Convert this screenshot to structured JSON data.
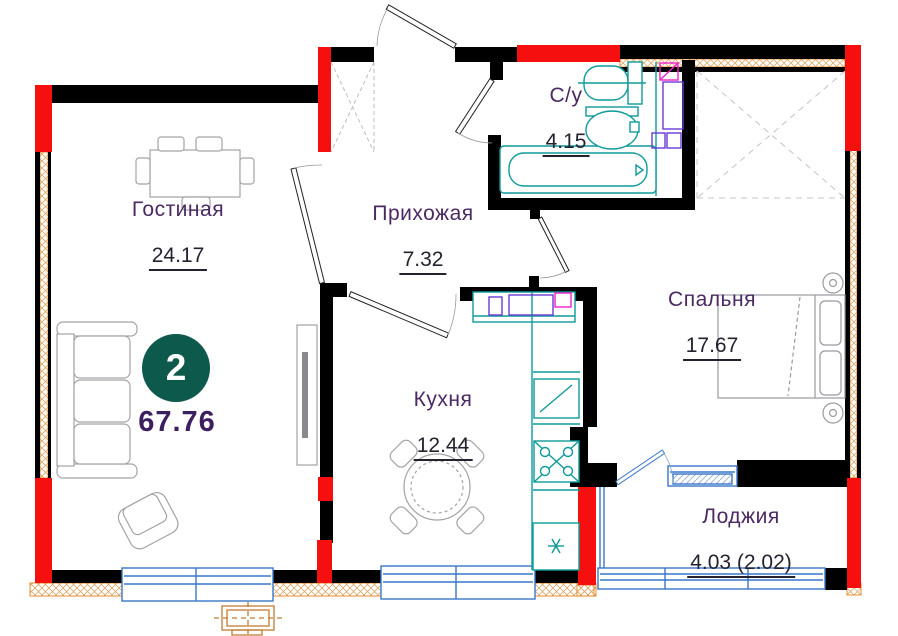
{
  "badge": {
    "rooms_count": "2",
    "total_area": "67.76"
  },
  "rooms": [
    {
      "name": "Гостиная",
      "area": "24.17"
    },
    {
      "name": "Прихожая",
      "area": "7.32"
    },
    {
      "name": "С/у",
      "area": "4.15"
    },
    {
      "name": "Спальня",
      "area": "17.67"
    },
    {
      "name": "Кухня",
      "area": "12.44"
    },
    {
      "name": "Лоджия",
      "area": "4.03 (2.02)"
    }
  ],
  "colors": {
    "wall_black": "#000000",
    "wall_accent_red": "#f50f0f",
    "window_blue": "#3a76c8",
    "fixture_teal": "#0e9a9a",
    "appliance_purple": "#6a3bd6",
    "appliance_magenta": "#ee22cc",
    "insulation_orange": "#e8821e",
    "furniture_gray": "#a3a3a8",
    "label_purple": "#4b2963",
    "area_text_dark": "#26212e",
    "badge_teal": "#0d594c",
    "ac_unit_orange": "#c27d33"
  },
  "icons": {
    "fridge": "snowflake-asterisk",
    "doors": "quarter-swing-leaf",
    "insulation": "orange-crosshatch-strip"
  }
}
